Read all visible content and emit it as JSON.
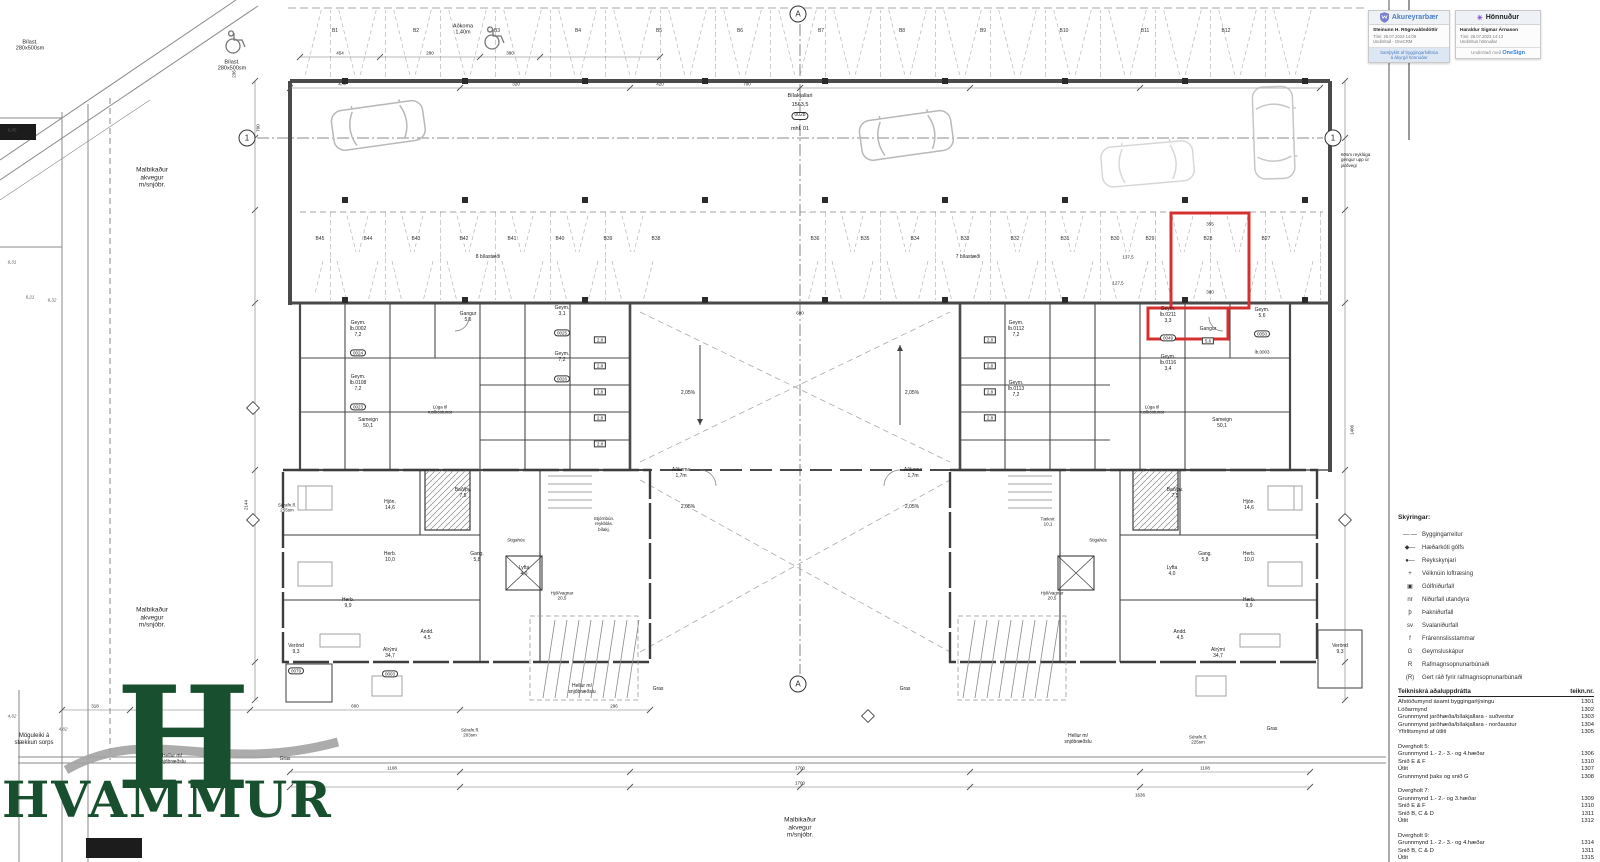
{
  "stamps": {
    "municipality": {
      "title": "Akureyrarbær",
      "name": "Steinunn H. Rögnvaldsdóttir",
      "time": "Tími: 26.07.2023 14:09",
      "method": "Undirritað - OneCRM",
      "approval_line1": "Samþykkt af byggingarfulltrúa",
      "approval_line2": "á ábyrgð hönnuðar"
    },
    "designer": {
      "title": "Hönnuður",
      "icon": "✳",
      "name": "Haraldur Sigmar Árnason",
      "time": "Tími: 26.07.2023 14:13",
      "method": "Undirritun hönnuðar",
      "signed_prefix": "Undirritað með",
      "signed_brand": "OneSign"
    }
  },
  "logo": {
    "monogram": "H",
    "text": "HVAMMUR",
    "color": "#184f2e"
  },
  "colors": {
    "highlight": "#d43030",
    "logo_green": "#184f2e",
    "stamp_blue": "#4a7dc0"
  },
  "legend": {
    "title": "Skýringar:",
    "items": [
      {
        "sym": "—·—",
        "label": "Byggingarreitur"
      },
      {
        "sym": "◆—",
        "label": "Hæðarkóti gólfs"
      },
      {
        "sym": "●—",
        "label": "Reykskynjari"
      },
      {
        "sym": "+",
        "label": "Vélknúin loftræsing"
      },
      {
        "sym": "▣",
        "label": "Gólfniðurfall"
      },
      {
        "sym": "nr",
        "label": "Niðurfall utandyra"
      },
      {
        "sym": "þ",
        "label": "Þakniðurfall"
      },
      {
        "sym": "sv",
        "label": "Svalaniðurfall"
      },
      {
        "sym": "f",
        "label": "Frárennslisstammar"
      },
      {
        "sym": "G",
        "label": "Geymsluskápur"
      },
      {
        "sym": "R",
        "label": "Rafmagnsopnunarbúnaði"
      },
      {
        "sym": "(R)",
        "label": "Gert ráð fyrir rafmagnsopnunarbúnaði"
      }
    ]
  },
  "drawing_list": {
    "title": "Teikniskrá aðaluppdrátta",
    "number_header": "teikn.nr.",
    "rows": [
      {
        "label": "Afstöðumynd ásamt byggingarlýsingu",
        "nr": "1301"
      },
      {
        "label": "Lóðarmynd",
        "nr": "1302"
      },
      {
        "label": "Grunnmynd jarðhæða/bílakjallara - suðvestur",
        "nr": "1303"
      },
      {
        "label": "Grunnmynd jarðhæða/bílakjallara - norðaustur",
        "nr": "1304"
      },
      {
        "label": "Yfirlitsmynd af útliti",
        "nr": "1305"
      },
      {
        "label": "Dvergholt 5:",
        "nr": "",
        "group": true
      },
      {
        "label": "Grunnmynd 1.- 2.- 3.- og 4.hæðar",
        "nr": "1306"
      },
      {
        "label": "Snið E & F",
        "nr": "1310"
      },
      {
        "label": "Útlit",
        "nr": "1307"
      },
      {
        "label": "Grunnmynd þaks og snið G",
        "nr": "1308"
      },
      {
        "label": "Dvergholt 7:",
        "nr": "",
        "group": true
      },
      {
        "label": "Grunnmynd 1.- 2.- og 3.hæðar",
        "nr": "1309"
      },
      {
        "label": "Snið E & F",
        "nr": "1310"
      },
      {
        "label": "Snið B, C & D",
        "nr": "1311"
      },
      {
        "label": "Útlit",
        "nr": "1312"
      },
      {
        "label": "Dvergholt 9:",
        "nr": "",
        "group": true
      },
      {
        "label": "Grunnmynd 1.- 2.- 3.- og 4.hæðar",
        "nr": "1314"
      },
      {
        "label": "Snið B, C & D",
        "nr": "1311"
      },
      {
        "label": "Útlit",
        "nr": "1315"
      },
      {
        "label": "Grunnmynd þaks og snið A",
        "nr": "1316"
      }
    ]
  },
  "parking": {
    "highlight_stall": "B28",
    "groups": [
      {
        "y": 32,
        "x0": 335,
        "pitch": 81,
        "labels": [
          "B1",
          "B2",
          "B3",
          "B4",
          "B5",
          "B6",
          "B7",
          "B8",
          "B9",
          "B10",
          "B11",
          "B12"
        ]
      },
      {
        "y": 240,
        "x0": 320,
        "pitch": 48,
        "labels": [
          "B45",
          "B44",
          "B43",
          "B42",
          "B41",
          "B40",
          "B39",
          "B38"
        ]
      },
      {
        "y": 240,
        "x0": 815,
        "pitch": 50,
        "labels": [
          "B36",
          "B35",
          "B34",
          "B33",
          "B32",
          "B31",
          "B30"
        ]
      },
      {
        "y": 240,
        "x0": 1150,
        "pitch": 58,
        "labels": [
          "B29",
          "B28",
          "B27"
        ]
      }
    ]
  },
  "plan": {
    "labels": [
      {
        "t": "Malbikaður\nakvegur\nm/snjóbr.",
        "x": 152,
        "y": 178,
        "s": 6.5
      },
      {
        "t": "Malbikaður\nakvegur\nm/snjóbr.",
        "x": 152,
        "y": 618,
        "s": 6.5
      },
      {
        "t": "Malbikaður\nakvegur\nm/snjóbr.",
        "x": 800,
        "y": 828,
        "s": 6.5
      },
      {
        "t": "Möguleiki á\nstækkun sorps",
        "x": 34,
        "y": 740,
        "s": 6
      },
      {
        "t": "Bílast.\n280x500sm",
        "x": 30,
        "y": 46,
        "s": 5.5
      },
      {
        "t": "Bílast.\n280x500sm",
        "x": 232,
        "y": 66,
        "s": 5.5
      },
      {
        "t": "Aðkoma\n1,40m",
        "x": 463,
        "y": 30,
        "s": 5.5
      },
      {
        "t": "60sm reyklúga\ngengur upp úr\njarðvegi",
        "x": 1341,
        "y": 160,
        "s": 4.5,
        "al": "left"
      },
      {
        "t": "Bílakjallari",
        "x": 800,
        "y": 96,
        "s": 5.5
      },
      {
        "t": "1563,5",
        "x": 800,
        "y": 105,
        "s": 5.5
      },
      {
        "t": "0028",
        "x": 800,
        "y": 116,
        "s": 5,
        "cls": "pill"
      },
      {
        "t": "mhl. 01",
        "x": 800,
        "y": 129,
        "s": 5.5
      },
      {
        "t": "8 bílastæði",
        "x": 488,
        "y": 258,
        "s": 5
      },
      {
        "t": "7 bílastæði",
        "x": 968,
        "y": 258,
        "s": 5
      },
      {
        "t": "355",
        "x": 1210,
        "y": 224,
        "s": 4.5
      },
      {
        "t": "380",
        "x": 1210,
        "y": 292,
        "s": 4.5
      },
      {
        "t": "137,5",
        "x": 1128,
        "y": 257,
        "s": 4.5
      },
      {
        "t": "127,5",
        "x": 1118,
        "y": 283,
        "s": 4.5
      },
      {
        "t": "2,05%",
        "x": 688,
        "y": 394,
        "s": 5
      },
      {
        "t": "2,05%",
        "x": 912,
        "y": 394,
        "s": 5
      },
      {
        "t": "2,05%",
        "x": 688,
        "y": 508,
        "s": 5
      },
      {
        "t": "2,05%",
        "x": 912,
        "y": 508,
        "s": 5
      },
      {
        "t": "Aðkoma\n1,7m",
        "x": 681,
        "y": 474,
        "s": 5
      },
      {
        "t": "Aðkoma\n1,7m",
        "x": 913,
        "y": 474,
        "s": 5
      },
      {
        "t": "Geym.\nÍb.0002\n7,2",
        "x": 358,
        "y": 330,
        "s": 5
      },
      {
        "t": "0024",
        "x": 358,
        "y": 353,
        "s": 4.5,
        "cls": "pill"
      },
      {
        "t": "Gangur\n5,6",
        "x": 468,
        "y": 318,
        "s": 5
      },
      {
        "t": "Geym.\n3,1",
        "x": 562,
        "y": 312,
        "s": 5
      },
      {
        "t": "0025",
        "x": 562,
        "y": 333,
        "s": 4.5,
        "cls": "pill"
      },
      {
        "t": "Geym.\n7,2",
        "x": 562,
        "y": 358,
        "s": 5
      },
      {
        "t": "0026",
        "x": 562,
        "y": 379,
        "s": 4.5,
        "cls": "pill"
      },
      {
        "t": "Geym.\nÍb.0108\n7,2",
        "x": 358,
        "y": 384,
        "s": 5
      },
      {
        "t": "0023",
        "x": 358,
        "y": 407,
        "s": 4.5,
        "cls": "pill"
      },
      {
        "t": "Sameign\n50,1",
        "x": 368,
        "y": 424,
        "s": 5
      },
      {
        "t": "Lúga til\nruslköstunar",
        "x": 440,
        "y": 410,
        "s": 4.5
      },
      {
        "t": "2,8",
        "x": 600,
        "y": 340,
        "s": 4.5,
        "cls": "box"
      },
      {
        "t": "2,8",
        "x": 600,
        "y": 366,
        "s": 4.5,
        "cls": "box"
      },
      {
        "t": "2,8",
        "x": 600,
        "y": 392,
        "s": 4.5,
        "cls": "box"
      },
      {
        "t": "2,8",
        "x": 600,
        "y": 418,
        "s": 4.5,
        "cls": "box"
      },
      {
        "t": "2,8",
        "x": 600,
        "y": 444,
        "s": 4.5,
        "cls": "box"
      },
      {
        "t": "2,8",
        "x": 990,
        "y": 340,
        "s": 4.5,
        "cls": "box"
      },
      {
        "t": "2,8",
        "x": 990,
        "y": 366,
        "s": 4.5,
        "cls": "box"
      },
      {
        "t": "2,8",
        "x": 990,
        "y": 392,
        "s": 4.5,
        "cls": "box"
      },
      {
        "t": "2,8",
        "x": 990,
        "y": 418,
        "s": 4.5,
        "cls": "box"
      },
      {
        "t": "Geym.\nÍb.0211\n3,3",
        "x": 1168,
        "y": 316,
        "s": 5
      },
      {
        "t": "0049",
        "x": 1168,
        "y": 338,
        "s": 4.5,
        "cls": "pill"
      },
      {
        "t": "Gangur",
        "x": 1208,
        "y": 330,
        "s": 5
      },
      {
        "t": "5,6",
        "x": 1208,
        "y": 341,
        "s": 4.5,
        "cls": "box"
      },
      {
        "t": "Geym.\n5,6",
        "x": 1262,
        "y": 314,
        "s": 5
      },
      {
        "t": "0050",
        "x": 1262,
        "y": 334,
        "s": 4.5,
        "cls": "pill"
      },
      {
        "t": "Íb.0003",
        "x": 1262,
        "y": 352,
        "s": 4.5
      },
      {
        "t": "Geym.\nÍb.0116\n3,4",
        "x": 1168,
        "y": 364,
        "s": 5
      },
      {
        "t": "Geym.\nÍb.0112\n7,2",
        "x": 1016,
        "y": 330,
        "s": 5
      },
      {
        "t": "Geym.\nÍb.0113\n7,2",
        "x": 1016,
        "y": 390,
        "s": 5
      },
      {
        "t": "Sameign\n50,1",
        "x": 1222,
        "y": 424,
        "s": 5
      },
      {
        "t": "Lúga til\nruslköstunar",
        "x": 1152,
        "y": 410,
        "s": 4.5
      },
      {
        "t": "Hjón.\n14,6",
        "x": 390,
        "y": 506,
        "s": 5
      },
      {
        "t": "Bað/þv.\n7,5",
        "x": 463,
        "y": 494,
        "s": 5
      },
      {
        "t": "Herb.\n10,0",
        "x": 390,
        "y": 558,
        "s": 5
      },
      {
        "t": "Gang.\n5,8",
        "x": 477,
        "y": 558,
        "s": 5
      },
      {
        "t": "Lyfta\n4,0",
        "x": 524,
        "y": 572,
        "s": 5
      },
      {
        "t": "Herb.\n9,9",
        "x": 348,
        "y": 604,
        "s": 5
      },
      {
        "t": "Andd.\n4,5",
        "x": 427,
        "y": 636,
        "s": 5
      },
      {
        "t": "Alrými\n34,7",
        "x": 390,
        "y": 654,
        "s": 5
      },
      {
        "t": "0003",
        "x": 390,
        "y": 674,
        "s": 4.5,
        "cls": "pill"
      },
      {
        "t": "Verönd\n9,3",
        "x": 296,
        "y": 650,
        "s": 5
      },
      {
        "t": "0079",
        "x": 296,
        "y": 671,
        "s": 4.5,
        "cls": "pill"
      },
      {
        "t": "Stjórnbún.\nreykblás.\nbílakj.",
        "x": 604,
        "y": 524,
        "s": 4.5
      },
      {
        "t": "Hjól/vagnar\n20,5",
        "x": 562,
        "y": 596,
        "s": 4.5
      },
      {
        "t": "Stigahús",
        "x": 516,
        "y": 540,
        "s": 4.5
      },
      {
        "t": "Hjón.\n14,6",
        "x": 1249,
        "y": 506,
        "s": 5
      },
      {
        "t": "Bað/þv.\n7,5",
        "x": 1175,
        "y": 494,
        "s": 5
      },
      {
        "t": "Herb.\n10,0",
        "x": 1249,
        "y": 558,
        "s": 5
      },
      {
        "t": "Gang.\n5,8",
        "x": 1205,
        "y": 558,
        "s": 5
      },
      {
        "t": "Lyfta\n4,0",
        "x": 1172,
        "y": 572,
        "s": 5
      },
      {
        "t": "Herb.\n9,9",
        "x": 1249,
        "y": 604,
        "s": 5
      },
      {
        "t": "Andd.\n4,5",
        "x": 1180,
        "y": 636,
        "s": 5
      },
      {
        "t": "Alrými\n34,7",
        "x": 1218,
        "y": 654,
        "s": 5
      },
      {
        "t": "Verönd\n9,3",
        "x": 1340,
        "y": 650,
        "s": 5
      },
      {
        "t": "Tæknir.\n10,1",
        "x": 1048,
        "y": 522,
        "s": 4.5
      },
      {
        "t": "Hjól/vagnar\n20,5",
        "x": 1052,
        "y": 596,
        "s": 4.5
      },
      {
        "t": "Stigahús",
        "x": 1098,
        "y": 540,
        "s": 4.5
      },
      {
        "t": "Hellur m/\nsnjóbræðslu",
        "x": 582,
        "y": 690,
        "s": 5
      },
      {
        "t": "Hellur m/\nsnjóbræðslu",
        "x": 1078,
        "y": 740,
        "s": 5
      },
      {
        "t": "Hellur m/\nsnjóbræðslu",
        "x": 172,
        "y": 760,
        "s": 5
      },
      {
        "t": "Gras",
        "x": 658,
        "y": 690,
        "s": 5
      },
      {
        "t": "Gras",
        "x": 905,
        "y": 690,
        "s": 5
      },
      {
        "t": "Gras",
        "x": 1272,
        "y": 730,
        "s": 5
      },
      {
        "t": "Gras",
        "x": 285,
        "y": 760,
        "s": 5
      },
      {
        "t": "Sérafn.fl.\n203sm",
        "x": 470,
        "y": 733,
        "s": 4.5
      },
      {
        "t": "Sérafn.fl.\n225sm",
        "x": 1198,
        "y": 740,
        "s": 4.5
      },
      {
        "t": "Sérafn.fl.\n255sm",
        "x": 287,
        "y": 508,
        "s": 4.5
      },
      {
        "t": "6,95",
        "x": 12,
        "y": 130,
        "s": 4.5,
        "cls": "it"
      },
      {
        "t": "6,31",
        "x": 12,
        "y": 262,
        "s": 4.5,
        "cls": "it"
      },
      {
        "t": "6,21",
        "x": 30,
        "y": 297,
        "s": 4.5,
        "cls": "it"
      },
      {
        "t": "6,32",
        "x": 52,
        "y": 300,
        "s": 4.5,
        "cls": "it"
      },
      {
        "t": "4,82",
        "x": 63,
        "y": 729,
        "s": 4.5,
        "cls": "it"
      },
      {
        "t": "4,62",
        "x": 12,
        "y": 716,
        "s": 4.5,
        "cls": "it"
      },
      {
        "t": "454",
        "x": 340,
        "y": 53,
        "s": 4.5
      },
      {
        "t": "280",
        "x": 430,
        "y": 53,
        "s": 4.5
      },
      {
        "t": "380",
        "x": 510,
        "y": 53,
        "s": 4.5
      },
      {
        "t": "474",
        "x": 342,
        "y": 84,
        "s": 4.5
      },
      {
        "t": "320",
        "x": 516,
        "y": 84,
        "s": 4.5
      },
      {
        "t": "420",
        "x": 660,
        "y": 84,
        "s": 4.5
      },
      {
        "t": "700",
        "x": 747,
        "y": 84,
        "s": 4.5
      },
      {
        "t": "600",
        "x": 800,
        "y": 313,
        "s": 4.5
      },
      {
        "t": "1700",
        "x": 800,
        "y": 768,
        "s": 4.5
      },
      {
        "t": "1700",
        "x": 800,
        "y": 783,
        "s": 4.5
      },
      {
        "t": "1108",
        "x": 392,
        "y": 768,
        "s": 4.5
      },
      {
        "t": "1108",
        "x": 1205,
        "y": 768,
        "s": 4.5
      },
      {
        "t": "1636",
        "x": 1140,
        "y": 795,
        "s": 4.5
      },
      {
        "t": "318",
        "x": 95,
        "y": 706,
        "s": 4.5
      },
      {
        "t": "600",
        "x": 355,
        "y": 706,
        "s": 4.5
      },
      {
        "t": "296",
        "x": 614,
        "y": 706,
        "s": 4.5
      },
      {
        "t": "700",
        "x": 258,
        "y": 128,
        "s": 4.5,
        "r": -90
      },
      {
        "t": "2144",
        "x": 246,
        "y": 505,
        "s": 4.5,
        "r": -90
      },
      {
        "t": "236",
        "x": 234,
        "y": 74,
        "s": 4.5,
        "r": -90
      },
      {
        "t": "1406",
        "x": 1352,
        "y": 430,
        "s": 4.5,
        "r": -90
      },
      {
        "t": "A",
        "x": 798,
        "y": 14,
        "s": 8,
        "cls": "marker"
      },
      {
        "t": "A",
        "x": 798,
        "y": 684,
        "s": 8,
        "cls": "marker"
      },
      {
        "t": "1",
        "x": 247,
        "y": 138,
        "s": 8,
        "cls": "marker"
      },
      {
        "t": "1",
        "x": 1333,
        "y": 138,
        "s": 8,
        "cls": "marker"
      }
    ]
  }
}
